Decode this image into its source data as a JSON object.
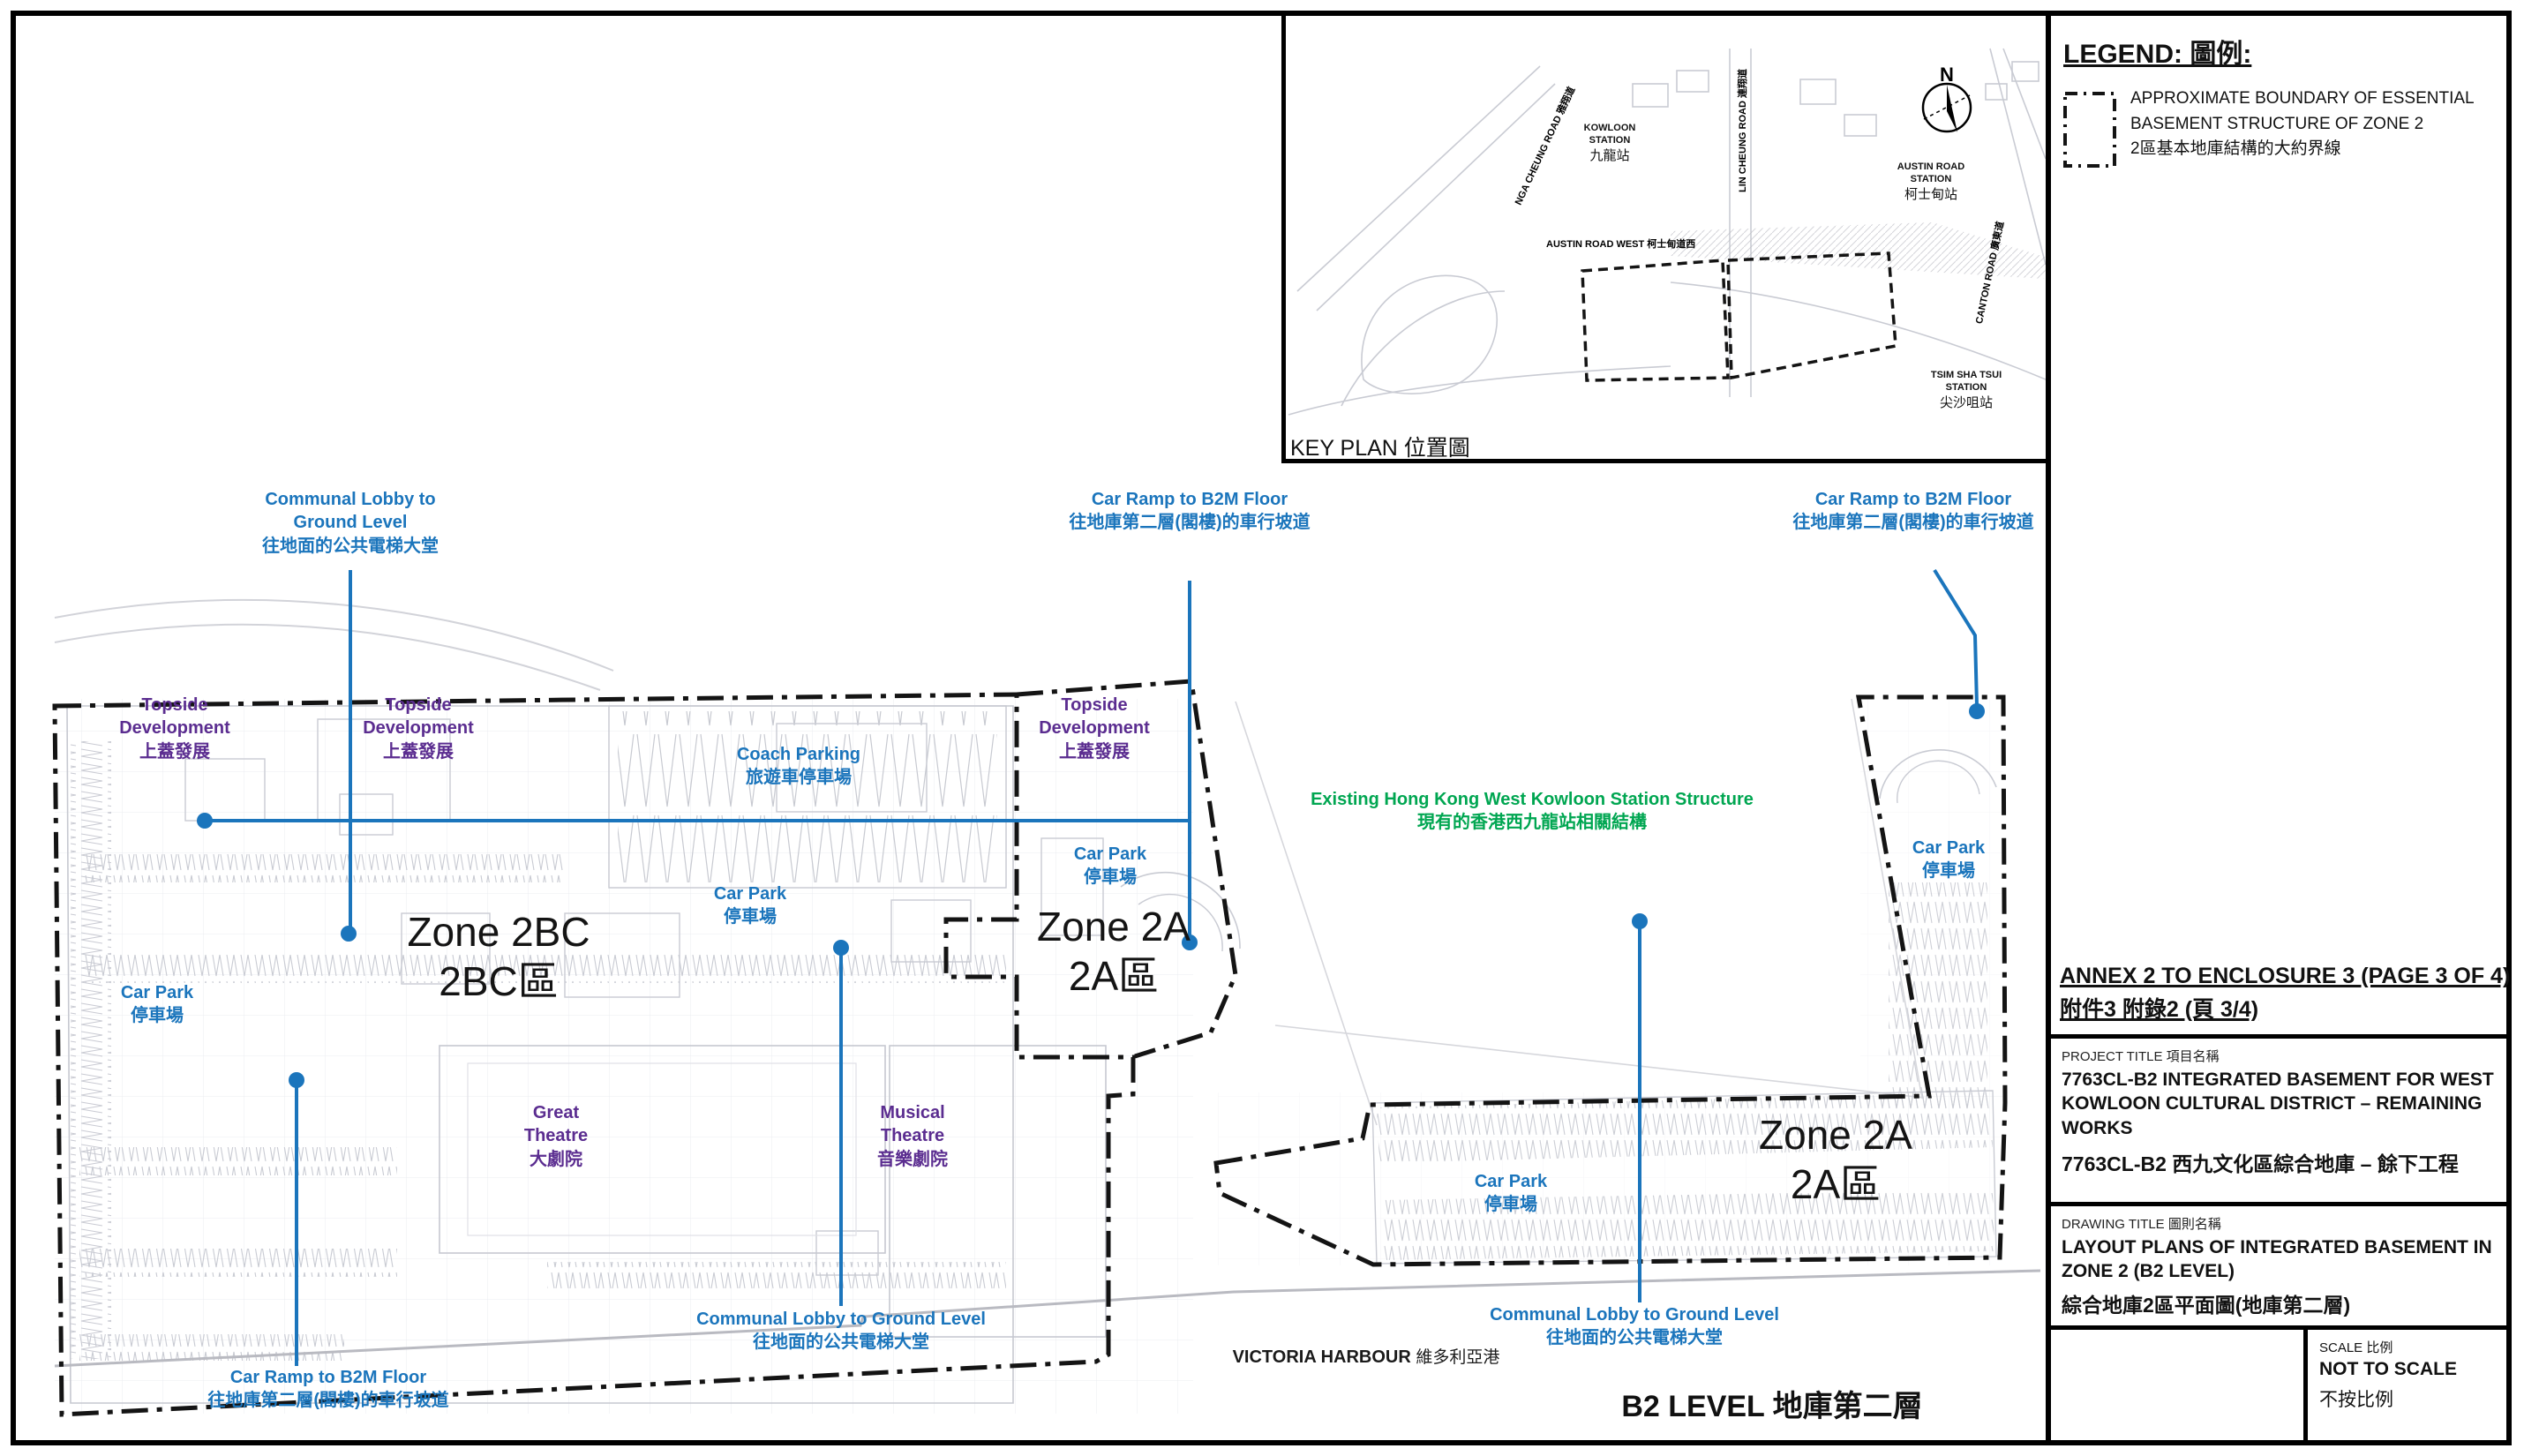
{
  "colors": {
    "annotation_blue": "#1b75bc",
    "annotation_purple": "#5b2d90",
    "annotation_green": "#00a651",
    "boundary_black": "#141414"
  },
  "legend": {
    "title": "LEGEND: 圖例:",
    "boundary_item": {
      "en1": "APPROXIMATE BOUNDARY OF ESSENTIAL",
      "en2": "BASEMENT STRUCTURE OF ZONE 2",
      "zh": "2區基本地庫結構的大約界線"
    }
  },
  "key_plan": {
    "caption": "KEY PLAN 位置圖",
    "north_label": "N",
    "stations": {
      "kowloon": {
        "en1": "KOWLOON",
        "en2": "STATION",
        "zh": "九龍站"
      },
      "austin_road": {
        "en1": "AUSTIN ROAD",
        "en2": "STATION",
        "zh": "柯士甸站"
      },
      "tsim_sha_tsui": {
        "en1": "TSIM SHA TSUI",
        "en2": "STATION",
        "zh": "尖沙咀站"
      }
    },
    "roads": {
      "lin_cheung": "LIN CHEUNG ROAD 連翔道",
      "canton": "CANTON ROAD 廣東道",
      "nga_cheung": "NGA CHEUNG ROAD 雅翔道",
      "austin_road_west": "AUSTIN ROAD WEST 柯士甸道西"
    }
  },
  "plan": {
    "level_caption": "B2 LEVEL 地庫第二層",
    "zone_labels": {
      "zone_2bc": {
        "en": "Zone 2BC",
        "zh": "2BC區"
      },
      "zone_2a_mid": {
        "en": "Zone 2A",
        "zh": "2A區"
      },
      "zone_2a_east": {
        "en": "Zone 2A",
        "zh": "2A區"
      }
    },
    "annotations": {
      "communal_lobby_top": {
        "en1": "Communal Lobby to",
        "en2": "Ground Level",
        "zh": "往地面的公共電梯大堂"
      },
      "car_ramp_top_center": {
        "en": "Car Ramp to B2M Floor",
        "zh": "往地庫第二層(閣樓)的車行坡道"
      },
      "car_ramp_top_right": {
        "en": "Car Ramp to B2M Floor",
        "zh": "往地庫第二層(閣樓)的車行坡道"
      },
      "car_ramp_bottom_left": {
        "en": "Car Ramp to B2M Floor",
        "zh": "往地庫第二層(閣樓)的車行坡道"
      },
      "communal_lobby_bottom_mid": {
        "en": "Communal Lobby to Ground Level",
        "zh": "往地面的公共電梯大堂"
      },
      "communal_lobby_bottom_right": {
        "en": "Communal Lobby to Ground Level",
        "zh": "往地面的公共電梯大堂"
      }
    },
    "areas": {
      "topside_west": {
        "en1": "Topside",
        "en2": "Development",
        "zh": "上蓋發展"
      },
      "topside_mid": {
        "en1": "Topside",
        "en2": "Development",
        "zh": "上蓋發展"
      },
      "topside_east": {
        "en1": "Topside",
        "en2": "Development",
        "zh": "上蓋發展"
      },
      "coach_parking": {
        "en": "Coach Parking",
        "zh": "旅遊車停車場"
      },
      "car_park_west": {
        "en": "Car Park",
        "zh": "停車場"
      },
      "car_park_central": {
        "en": "Car Park",
        "zh": "停車場"
      },
      "car_park_2a": {
        "en": "Car Park",
        "zh": "停車場"
      },
      "car_park_east": {
        "en": "Car Park",
        "zh": "停車場"
      },
      "car_park_south": {
        "en": "Car Park",
        "zh": "停車場"
      },
      "great_theatre": {
        "en1": "Great",
        "en2": "Theatre",
        "zh": "大劇院"
      },
      "musical_theatre": {
        "en1": "Musical",
        "en2": "Theatre",
        "zh": "音樂劇院"
      },
      "existing_station": {
        "en": "Existing Hong Kong West Kowloon Station Structure",
        "zh": "現有的香港西九龍站相關結構"
      },
      "victoria_harbour": {
        "en": "VICTORIA HARBOUR",
        "zh": "維多利亞港"
      }
    }
  },
  "title_block": {
    "annex": {
      "en": "ANNEX 2 TO ENCLOSURE 3 (PAGE 3 OF 4)",
      "zh": "附件3 附錄2 (頁 3/4)"
    },
    "project": {
      "heading": "PROJECT TITLE 項目名稱",
      "en1": "7763CL-B2 INTEGRATED BASEMENT FOR WEST",
      "en2": "KOWLOON CULTURAL DISTRICT – REMAINING",
      "en3": "WORKS",
      "zh": "7763CL-B2 西九文化區綜合地庫 – 餘下工程"
    },
    "drawing": {
      "heading": "DRAWING TITLE 圖則名稱",
      "en1": "LAYOUT PLANS OF INTEGRATED BASEMENT IN",
      "en2": "ZONE 2 (B2 LEVEL)",
      "zh": "綜合地庫2區平面圖(地庫第二層)"
    },
    "scale": {
      "heading": "SCALE 比例",
      "en": "NOT TO SCALE",
      "zh": "不按比例"
    }
  }
}
